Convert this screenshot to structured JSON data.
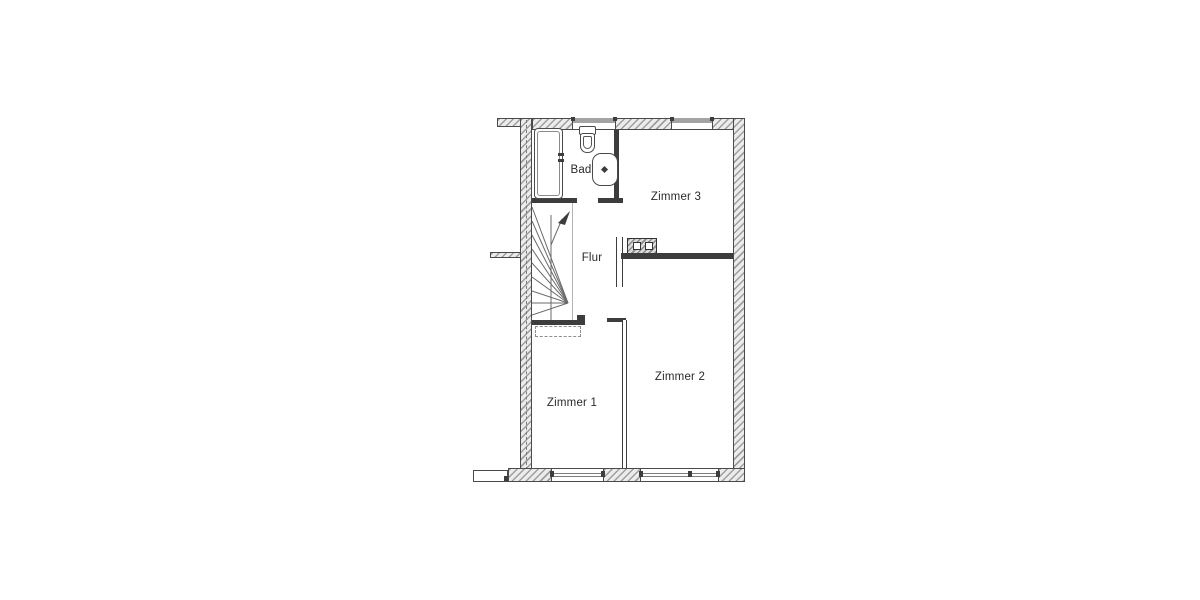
{
  "diagram": {
    "type": "floor-plan",
    "floor": "Obergeschoss (upper floor) of a terraced house",
    "rooms": [
      {
        "id": "bad",
        "label": "Bad"
      },
      {
        "id": "flur",
        "label": "Flur"
      },
      {
        "id": "zimmer1",
        "label": "Zimmer 1"
      },
      {
        "id": "zimmer2",
        "label": "Zimmer 2"
      },
      {
        "id": "zimmer3",
        "label": "Zimmer 3"
      }
    ],
    "fixtures": [
      {
        "id": "bathtub",
        "room": "Bad"
      },
      {
        "id": "toilet",
        "room": "Bad"
      },
      {
        "id": "washbasin",
        "room": "Bad"
      },
      {
        "id": "staircase",
        "room": "Flur"
      },
      {
        "id": "chimney-flue",
        "room": "Zimmer 3",
        "openings": 2
      }
    ],
    "colors": {
      "background": "#ffffff",
      "wall": "#3d3d3d",
      "hatch_stripe": "#9e9e9e",
      "hatch_bg": "#ececec",
      "window_band": "#a3a3a3",
      "text": "#2a2a2a"
    }
  }
}
